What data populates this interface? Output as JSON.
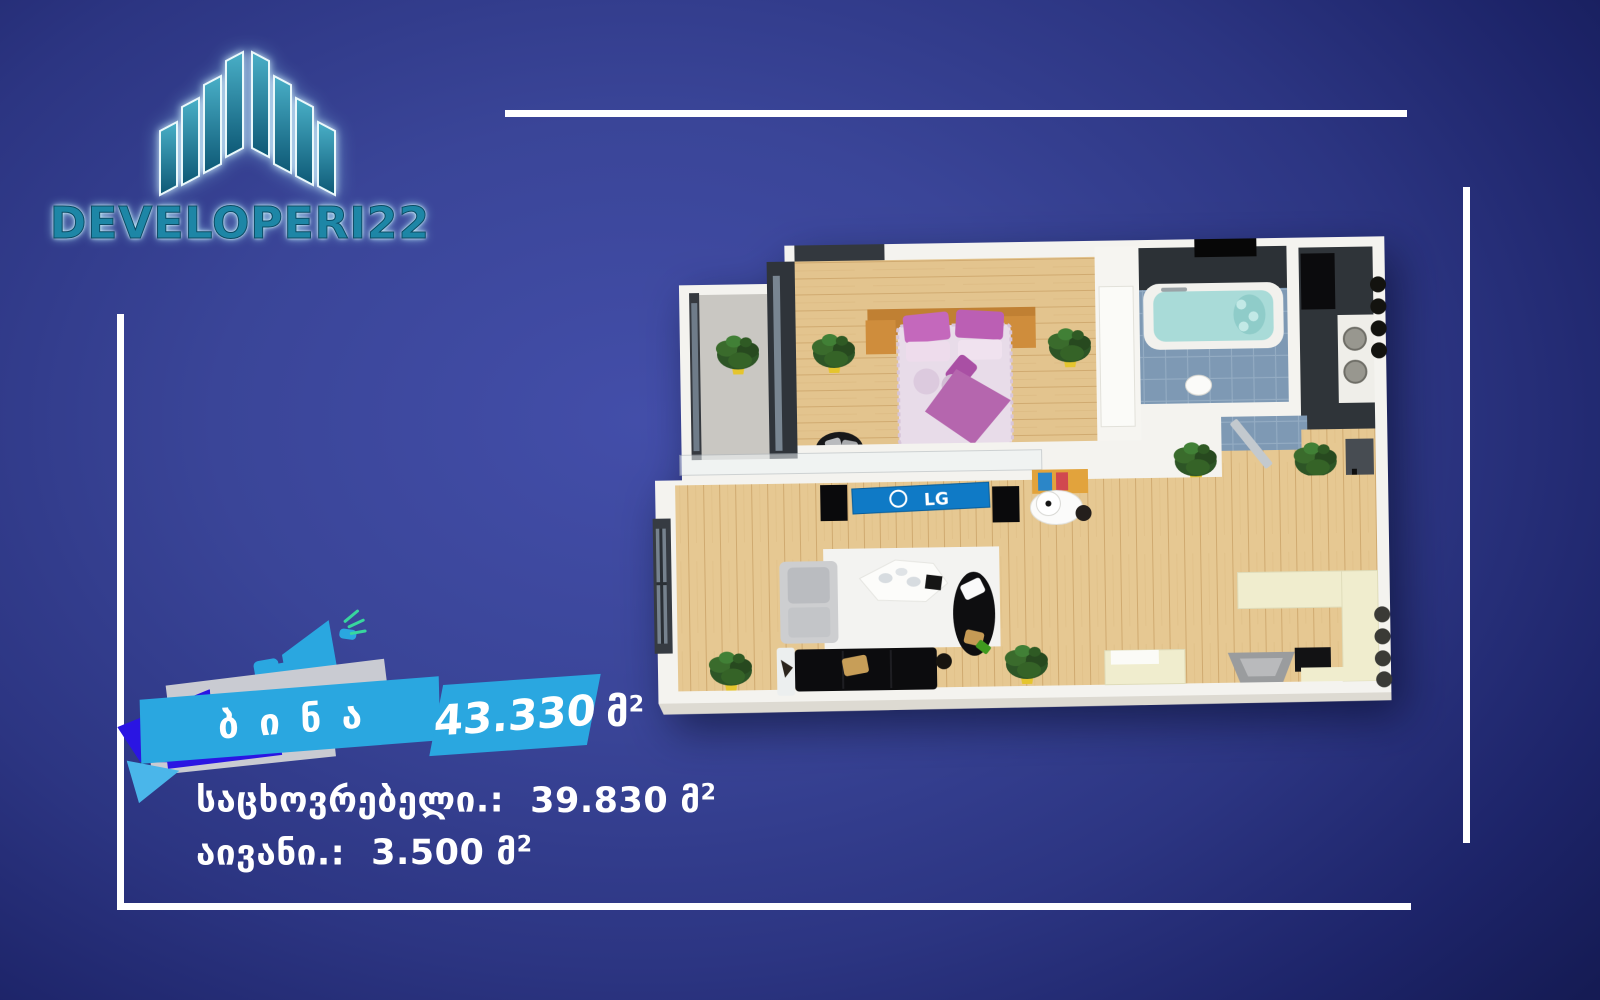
{
  "logo": {
    "icon": "buildings-logo-icon",
    "text": "DEVELOPERI22"
  },
  "banner": {
    "title": "ბინა",
    "area_value": "43.330",
    "area_unit": "მ",
    "area_sup": "2"
  },
  "details": {
    "rows": [
      {
        "label": "საცხოვრებელი.:",
        "value": "39.830",
        "unit": "მ",
        "sup": "2"
      },
      {
        "label": "აივანი.:",
        "value": "3.500",
        "unit": "მ",
        "sup": "2"
      }
    ]
  },
  "floorplan": {
    "tv_brand": "LG"
  },
  "colors": {
    "background_blue": "#333E93",
    "ribbon_blue": "#2AA7E0",
    "ribbon_indigo": "#2A15E3",
    "ribbon_gray": "#C9CBD2",
    "logo_teal": "#1D86A6",
    "wood_floor": "#E3C48E",
    "tile_blue": "#7E99B4",
    "frame_white": "#FFFFFF"
  }
}
